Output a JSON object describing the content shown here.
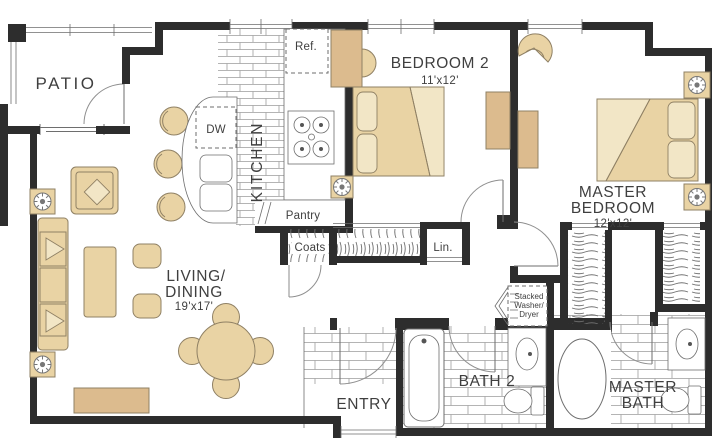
{
  "colors": {
    "bg": "#ffffff",
    "wall": "#2d2d2d",
    "line": "#6e6e6e",
    "arc": "#8f8f8f",
    "tile": "#9c9c9c",
    "text": "#3f3f3f",
    "furniture": "#e9d3a4",
    "furniture_dark": "#dcbb8e",
    "furniture_light": "#f2e6c6",
    "outline": "#8f8064"
  },
  "rooms": {
    "patio": {
      "label": "PATIO"
    },
    "kitchen": {
      "label": "KITCHEN"
    },
    "living": {
      "label1": "LIVING/",
      "label2": "DINING",
      "dims": "19'x17'"
    },
    "bedroom2": {
      "label": "BEDROOM 2",
      "dims": "11'x12'"
    },
    "master": {
      "label1": "MASTER",
      "label2": "BEDROOM",
      "dims": "12'x12'"
    },
    "entry": {
      "label": "ENTRY"
    },
    "bath2": {
      "label": "BATH 2"
    },
    "masterbath": {
      "label1": "MASTER",
      "label2": "BATH"
    }
  },
  "fixtures": {
    "ref": "Ref.",
    "dw": "DW",
    "pantry": "Pantry",
    "coats": "Coats",
    "linen": "Lin.",
    "washer": {
      "line1": "Stacked",
      "line2": "Washer/",
      "line3": "Dryer"
    }
  }
}
